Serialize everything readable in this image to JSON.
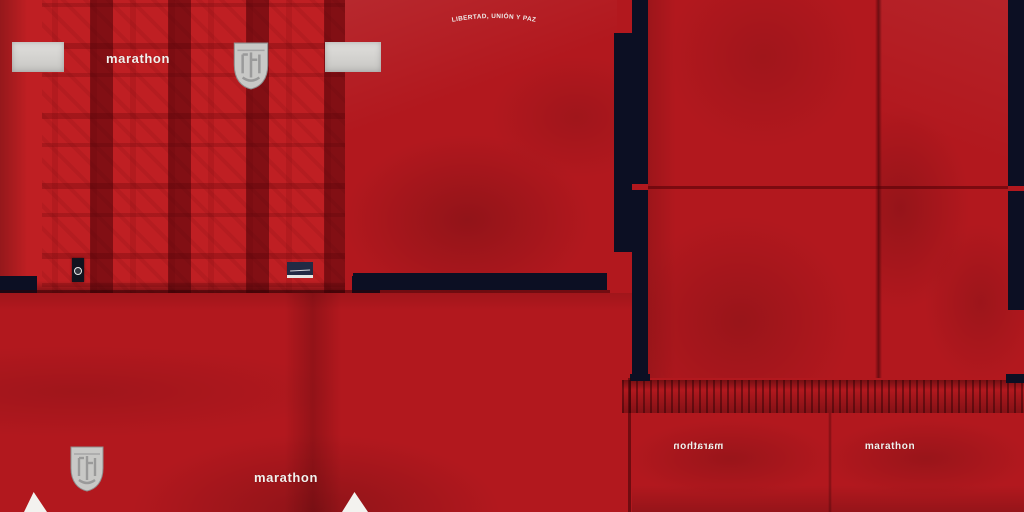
{
  "texture": {
    "title": "football kit texture sheet",
    "shirt_front": {
      "brand_label": "marathon",
      "crest_label": "FEF"
    },
    "shirt_back": {
      "motto": "LIBERTAD, UNIÓN Y PAZ"
    },
    "shorts_front": {
      "brand_label": "marathon",
      "crest_label": "FEF"
    },
    "shorts_back": {
      "brand_label_mirrored": "marathon",
      "brand_label": "marathon"
    },
    "colors": {
      "red": "#b2181e",
      "red_bright": "#bf1f23",
      "red_dark": "#7a0d12",
      "navy": "#0c0f23",
      "patch_gray": "#d9d8d5",
      "crest_gray": "#c8c8c6",
      "text_white": "#f3f1ee"
    }
  }
}
